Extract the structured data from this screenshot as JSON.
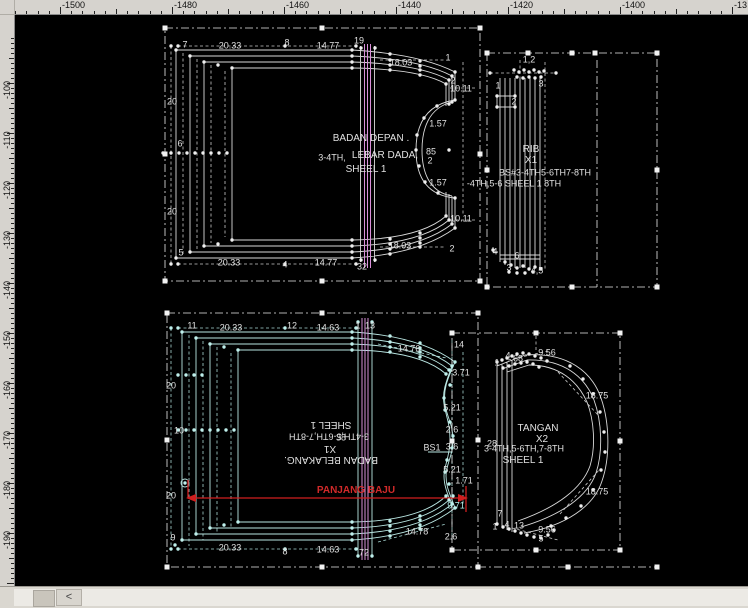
{
  "colors": {
    "background": "#000000",
    "ruler_bg": "#d6d3ce",
    "pattern_white": "#d9d9d9",
    "pattern_cyan": "#b9e6e2",
    "guide_pink": "#d98fd9",
    "dimension_red": "#cf1f1f",
    "label_default": "#e0e0e0",
    "label_cyan": "#b4eeea",
    "label_red": "#d22a2a"
  },
  "rulers": {
    "top": [
      {
        "t": "-1500",
        "x": 60
      },
      {
        "t": "-1480",
        "x": 172
      },
      {
        "t": "-1460",
        "x": 284
      },
      {
        "t": "-1440",
        "x": 396
      },
      {
        "t": "-1420",
        "x": 508
      },
      {
        "t": "-1400",
        "x": 620
      },
      {
        "t": "-13",
        "x": 732
      }
    ],
    "left": [
      {
        "t": "-100",
        "y": 83
      },
      {
        "t": "-110",
        "y": 133
      },
      {
        "t": "-120",
        "y": 183
      },
      {
        "t": "-130",
        "y": 233
      },
      {
        "t": "-140",
        "y": 283
      },
      {
        "t": "-150",
        "y": 333
      },
      {
        "t": "-160",
        "y": 383
      },
      {
        "t": "-170",
        "y": 433
      },
      {
        "t": "-180",
        "y": 483
      },
      {
        "t": "-190",
        "y": 533
      }
    ]
  },
  "pieces": {
    "front": {
      "name": "BADAN DEPAN",
      "note": "LEBAR DADA",
      "sizes": "3-4TH,5-6TH,7-8TH",
      "sheet": "SHEEL 1"
    },
    "rib": {
      "name": "RIB",
      "quantity": "X1"
    },
    "back": {
      "name": "BADAN BELAKANG",
      "quantity": "X1",
      "sizes": "3-4TH,5-6TH,7-8TH",
      "sheet": "SHEEL 1"
    },
    "sleeve": {
      "name": "TANGAN",
      "quantity": "X2",
      "sizes": "3-4TH,5-6TH,7-8TH",
      "sheet": "SHEEL 1"
    },
    "length_dimension": "PANJANG BAJU"
  },
  "labels": [
    {
      "t": "7",
      "x": 185,
      "y": 45
    },
    {
      "t": "20.33",
      "x": 230,
      "y": 46
    },
    {
      "t": "8",
      "x": 287,
      "y": 43
    },
    {
      "t": "14.77",
      "x": 328,
      "y": 46
    },
    {
      "t": "19",
      "x": 359,
      "y": 41
    },
    {
      "t": "18.03",
      "x": 401,
      "y": 63
    },
    {
      "t": "1",
      "x": 448,
      "y": 58
    },
    {
      "t": "2",
      "x": 453,
      "y": 81
    },
    {
      "t": "10.11",
      "x": 461,
      "y": 89
    },
    {
      "t": "20",
      "x": 172,
      "y": 102
    },
    {
      "t": "6",
      "x": 180,
      "y": 144
    },
    {
      "t": "20",
      "x": 172,
      "y": 212
    },
    {
      "t": "5",
      "x": 181,
      "y": 253
    },
    {
      "t": "20.33",
      "x": 229,
      "y": 263
    },
    {
      "t": "4",
      "x": 285,
      "y": 265
    },
    {
      "t": "14.77",
      "x": 326,
      "y": 263
    },
    {
      "t": "32",
      "x": 362,
      "y": 267
    },
    {
      "t": "18.03",
      "x": 400,
      "y": 246
    },
    {
      "t": "10.11",
      "x": 461,
      "y": 219
    },
    {
      "t": "2",
      "x": 452,
      "y": 249
    },
    {
      "t": "1.57",
      "x": 438,
      "y": 124
    },
    {
      "t": "85",
      "x": 431,
      "y": 152
    },
    {
      "t": "2",
      "x": 430,
      "y": 161
    },
    {
      "t": "1.57",
      "x": 438,
      "y": 183
    },
    {
      "t": "BADAN DEPAN .",
      "x": 371,
      "y": 139,
      "fs": 10
    },
    {
      "t": "3-4TH,",
      "x": 332,
      "y": 158
    },
    {
      "t": "LEBAR DADA,",
      "x": 385,
      "y": 156,
      "fs": 10
    },
    {
      "t": "SHEEL 1",
      "x": 366,
      "y": 170,
      "fs": 10
    },
    {
      "t": "1,2",
      "x": 529,
      "y": 60
    },
    {
      "t": "3",
      "x": 541,
      "y": 84
    },
    {
      "t": "1",
      "x": 498,
      "y": 86
    },
    {
      "t": "2",
      "x": 514,
      "y": 102
    },
    {
      "t": "RIB",
      "x": 531,
      "y": 150,
      "fs": 10
    },
    {
      "t": "X1",
      "x": 531,
      "y": 161,
      "fs": 10
    },
    {
      "t": "BS#3-4TH5-6TH7-8TH",
      "x": 545,
      "y": 173
    },
    {
      "t": "-4TH,5-6 SHEEL 1 8TH",
      "x": 514,
      "y": 184
    },
    {
      "t": "4",
      "x": 495,
      "y": 252
    },
    {
      "t": "6",
      "x": 517,
      "y": 256
    },
    {
      "t": "3",
      "x": 509,
      "y": 268
    },
    {
      "t": "4,5",
      "x": 537,
      "y": 271
    },
    {
      "t": "11",
      "x": 192,
      "y": 326
    },
    {
      "t": "20.33",
      "x": 231,
      "y": 328
    },
    {
      "t": "12",
      "x": 292,
      "y": 326
    },
    {
      "t": "14.63",
      "x": 328,
      "y": 328
    },
    {
      "t": "1",
      "x": 358,
      "y": 326
    },
    {
      "t": "13",
      "x": 370,
      "y": 326
    },
    {
      "t": "14.76",
      "x": 409,
      "y": 349
    },
    {
      "t": "14",
      "x": 459,
      "y": 345
    },
    {
      "t": "3.71",
      "x": 461,
      "y": 373
    },
    {
      "t": "20",
      "x": 171,
      "y": 386
    },
    {
      "t": "10",
      "x": 179,
      "y": 431
    },
    {
      "t": "20",
      "x": 171,
      "y": 496
    },
    {
      "t": "5.21",
      "x": 452,
      "y": 408
    },
    {
      "t": "2.6",
      "x": 452,
      "y": 430
    },
    {
      "t": "BS1",
      "x": 432,
      "y": 448
    },
    {
      "t": "3.6",
      "x": 452,
      "y": 447
    },
    {
      "t": "5.21",
      "x": 452,
      "y": 470
    },
    {
      "t": "1.71",
      "x": 464,
      "y": 481
    },
    {
      "t": "9.71",
      "x": 456,
      "y": 506,
      "c": "cyan"
    },
    {
      "t": "2.6",
      "x": 451,
      "y": 537
    },
    {
      "t": "SHEEL 1",
      "x": 331,
      "y": 424,
      "r": 180,
      "fs": 10
    },
    {
      "t": "3-4TH,5-6TH,7-8TH",
      "x": 329,
      "y": 436,
      "r": 180
    },
    {
      "t": "38",
      "x": 341,
      "y": 438
    },
    {
      "t": "X1",
      "x": 330,
      "y": 448,
      "r": 180,
      "fs": 10
    },
    {
      "t": "BADAN BELAKANG.",
      "x": 331,
      "y": 459,
      "r": 180,
      "fs": 10
    },
    {
      "t": "PANJANG BAJU",
      "x": 356,
      "y": 491,
      "c": "red",
      "fs": 10,
      "b": 1
    },
    {
      "t": "9",
      "x": 173,
      "y": 538
    },
    {
      "t": "20.33",
      "x": 230,
      "y": 548
    },
    {
      "t": "8",
      "x": 285,
      "y": 552
    },
    {
      "t": "14.63",
      "x": 328,
      "y": 550
    },
    {
      "t": "72",
      "x": 364,
      "y": 553
    },
    {
      "t": "14.78",
      "x": 417,
      "y": 532
    },
    {
      "t": "1",
      "x": 497,
      "y": 363
    },
    {
      "t": "4",
      "x": 508,
      "y": 356
    },
    {
      "t": "68",
      "x": 518,
      "y": 359
    },
    {
      "t": "9.56",
      "x": 547,
      "y": 353
    },
    {
      "t": "18.75",
      "x": 597,
      "y": 396
    },
    {
      "t": "TANGAN",
      "x": 538,
      "y": 429,
      "fs": 10
    },
    {
      "t": "X2",
      "x": 542,
      "y": 440,
      "fs": 10
    },
    {
      "t": "28",
      "x": 492,
      "y": 444
    },
    {
      "t": "3-4TH,5-6TH,7-8TH",
      "x": 524,
      "y": 449
    },
    {
      "t": "SHEEL 1",
      "x": 523,
      "y": 461,
      "fs": 10
    },
    {
      "t": "18.75",
      "x": 597,
      "y": 492
    },
    {
      "t": "7",
      "x": 500,
      "y": 514
    },
    {
      "t": "1",
      "x": 495,
      "y": 527
    },
    {
      "t": "4",
      "x": 507,
      "y": 525
    },
    {
      "t": "13",
      "x": 519,
      "y": 526
    },
    {
      "t": "9.56",
      "x": 547,
      "y": 530
    },
    {
      "t": "5",
      "x": 541,
      "y": 539
    }
  ],
  "scrollbar": {
    "left_arrow": "<"
  }
}
